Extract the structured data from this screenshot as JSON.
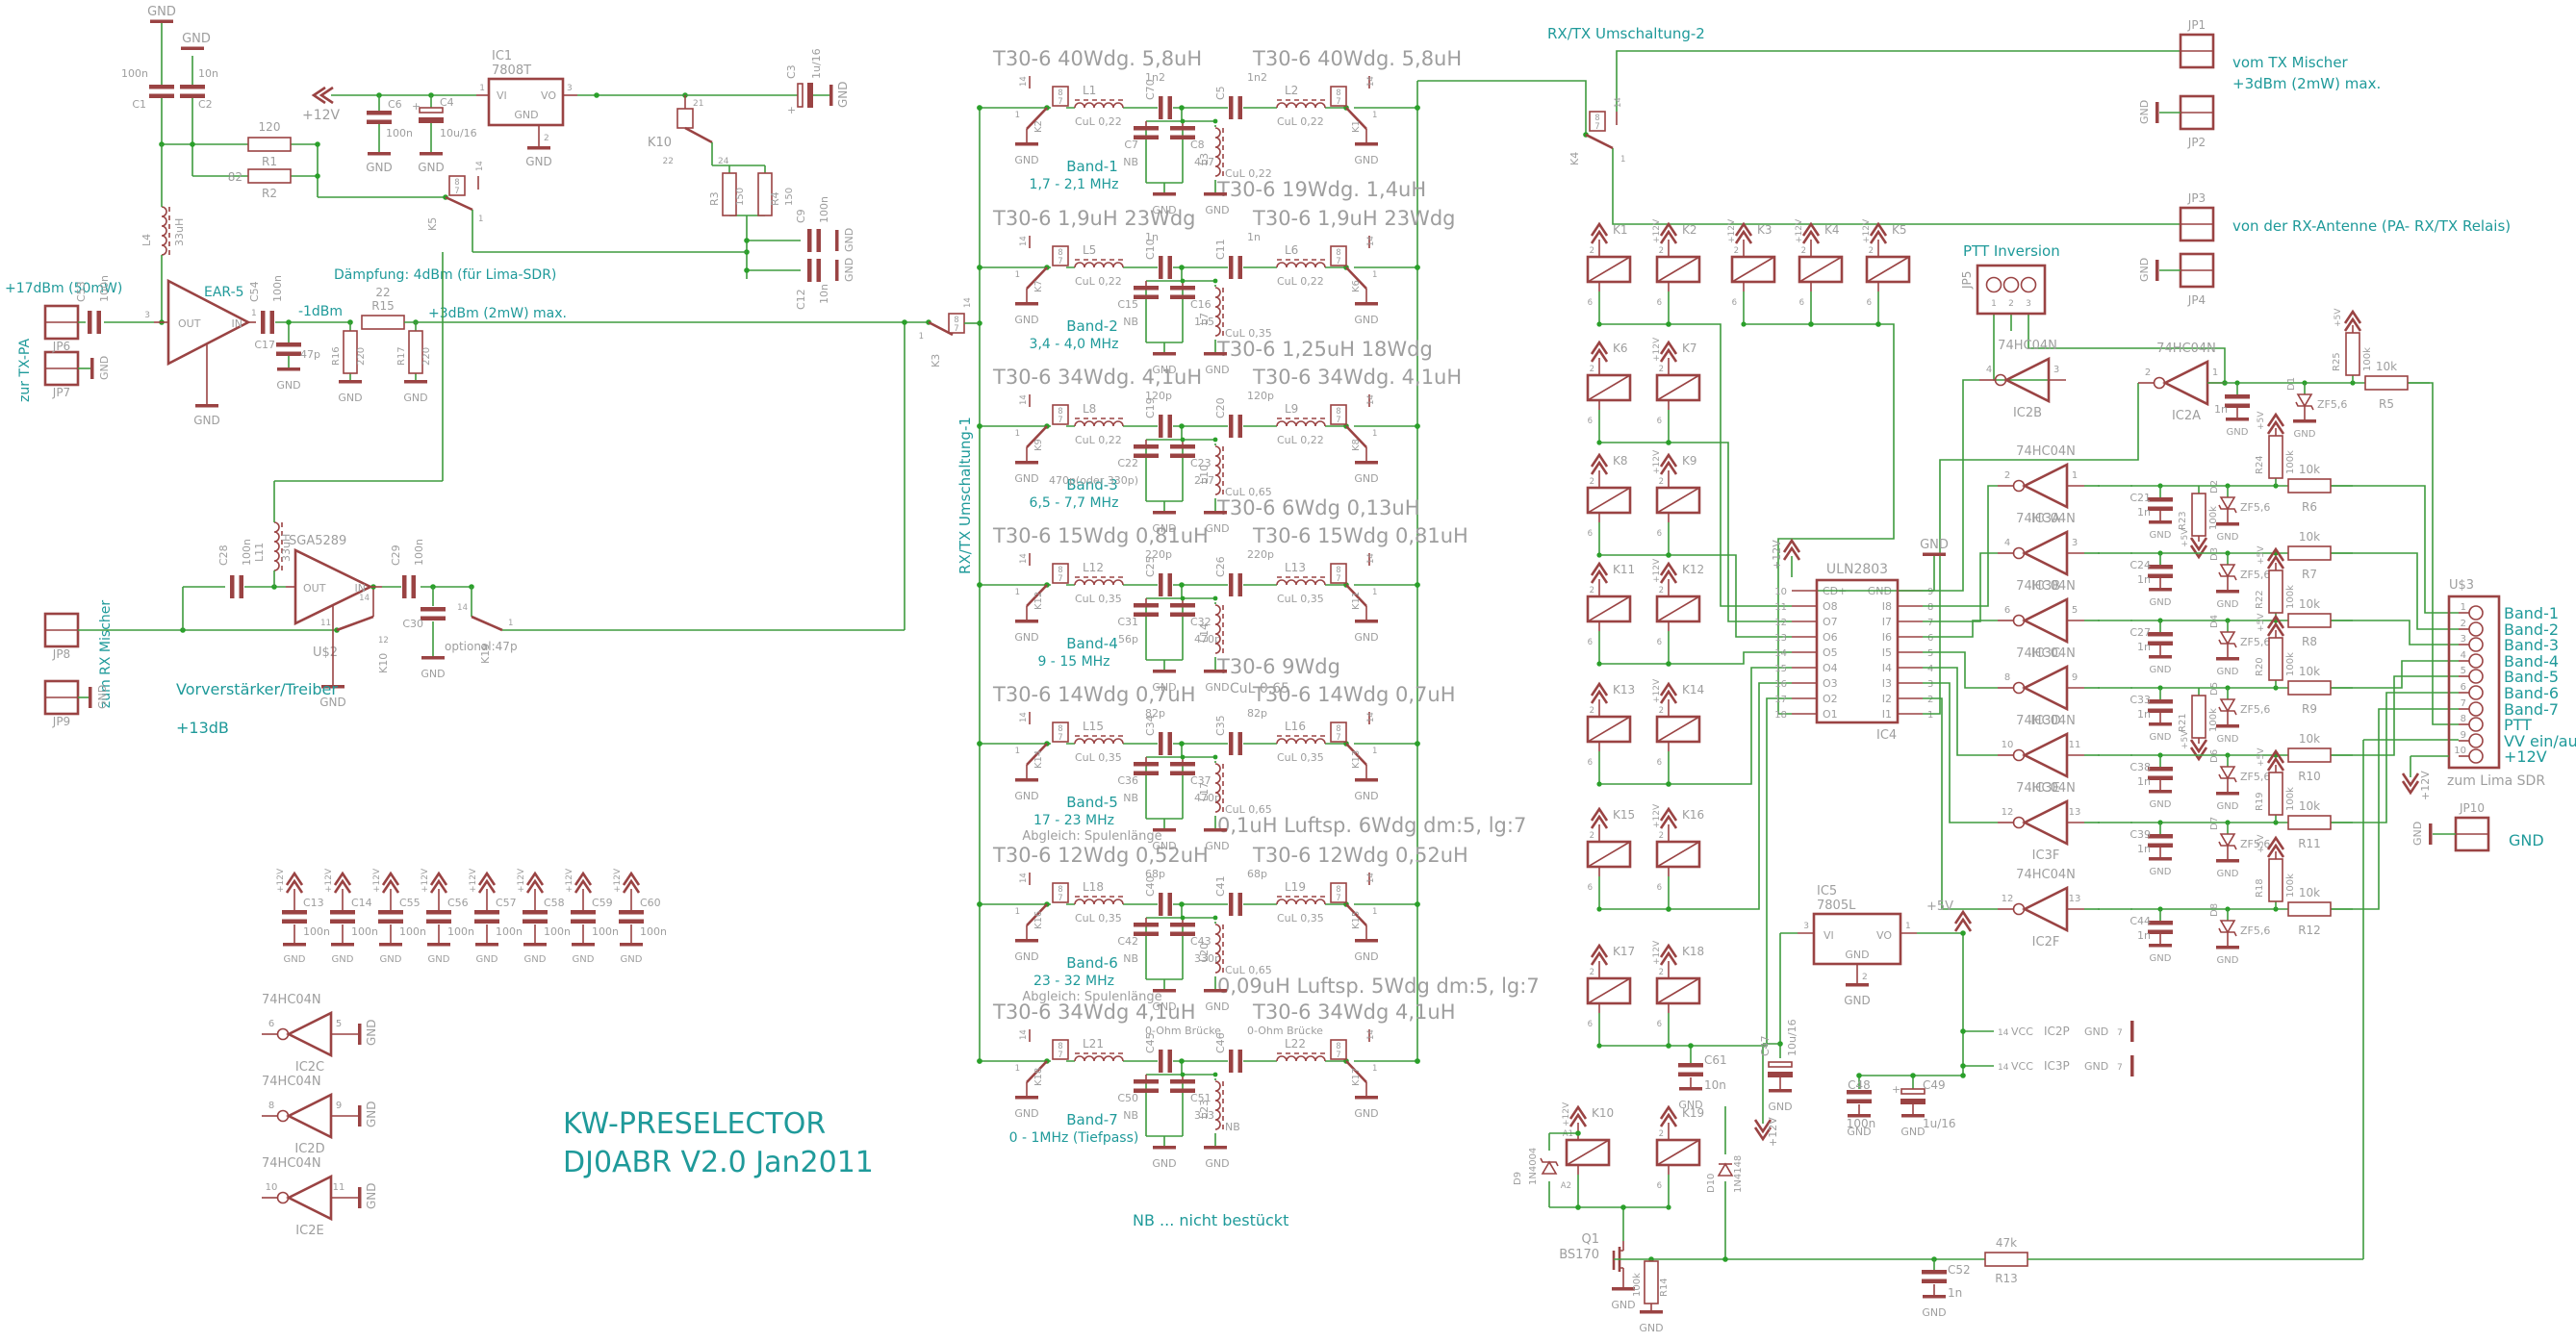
{
  "title": {
    "l1": "KW-PRESELECTOR",
    "l2": "DJ0ABR V2.0 Jan2011"
  },
  "shared": {
    "gnd": "GND",
    "p12": "+12V",
    "p5": "+5V",
    "vcc": "VCC",
    "hc": "74HC04N",
    "zf": "ZF5,6",
    "r10k": "10k",
    "v100n": "100n",
    "p1": "1",
    "p2": "2",
    "p3": "3",
    "p7": "7",
    "p8": "8",
    "p14": "14"
  },
  "notes": {
    "rxtx1": "RX/TX Umschaltung-1",
    "rxtx2": "RX/TX Umschaltung-2",
    "ptt": "PTT Inversion",
    "nb": "NB ... nicht bestückt",
    "vom_tx": "vom TX Mischer",
    "vom_tx_lvl": "+3dBm (2mW) max.",
    "von_rx": "von der RX-Antenne (PA- RX/TX Relais)",
    "zur_txpa": "zur TX-PA",
    "txpa_lvl": "+17dBm (50mW)",
    "zum_rx": "zum RX Mischer",
    "daempf": "Dämpfung: 4dBm (für Lima-SDR)",
    "m1dbm": "-1dBm",
    "p3dbm": "+3dBm (2mW) max.",
    "vorv": "Vorverstärker/Treiber",
    "p13": "+13dB",
    "zum_lima": "zum Lima SDR"
  },
  "psu": {
    "ic": "IC1",
    "part": "7808T",
    "vi": "VI",
    "vo": "VO",
    "gnd": "GND",
    "c1n": "C1",
    "c1v": "100n",
    "c2n": "C2",
    "c2v": "10n",
    "c6n": "C6",
    "c6v": "100n",
    "c4n": "C4",
    "c4v": "10u/16",
    "c3n": "C3",
    "c3v": "1u/16",
    "r1n": "R1",
    "r1v": "120",
    "r2n": "R2",
    "r2v": "82",
    "l4n": "L4",
    "l4v": "33uH",
    "k10": "K10",
    "k10a": "21",
    "k10b": "22",
    "k10c": "24",
    "k5": "K5",
    "r3n": "R3",
    "r3v": "150",
    "r4n": "R4",
    "r4v": "150",
    "c9n": "C9",
    "c9v": "100n",
    "c12n": "C12",
    "c12v": "10n"
  },
  "ear": {
    "name": "EAR-5",
    "out": "OUT",
    "in": "IN",
    "jp6": "JP6",
    "jp7": "JP7",
    "c53n": "C53",
    "c53v": "100n",
    "c54n": "C54",
    "c54v": "100n",
    "c17n": "C17",
    "c17v": "47p",
    "r15n": "R15",
    "r15v": "22",
    "r16n": "R16",
    "r16v": "220",
    "r17n": "R17",
    "r17v": "220"
  },
  "sga": {
    "name": "SGA5289",
    "ref": "U$2",
    "out": "OUT",
    "in": "IN",
    "jp8": "JP8",
    "jp9": "JP9",
    "c28n": "C28",
    "c28v": "100n",
    "c29n": "C29",
    "c29v": "100n",
    "c30n": "C30",
    "c30v": "optional:47p",
    "l11n": "L11",
    "l11v": "33uH",
    "k10": "K10",
    "k10a": "11",
    "k10b": "12",
    "k10c": "14",
    "k19": "K19"
  },
  "k3": "K3",
  "k4": "K4",
  "filters": [
    {
      "tl": "T30-6 40Wdg. 5,8uH",
      "tr": "T30-6 40Wdg. 5,8uH",
      "mid": "T30-6 19Wdg. 1,4uH",
      "mid2": "",
      "band": "Band-1",
      "range": "1,7 - 2,1 MHz",
      "note": "",
      "kl": "K2",
      "kr": "K1",
      "ll_n": "L1",
      "ll_v": "CuL 0,22",
      "lr_n": "L2",
      "lr_v": "CuL 0,22",
      "lm_n": "L3",
      "lm_v": "CuL 0,22",
      "csl_n": "C70",
      "csl_v": "1n2",
      "csr_n": "C5",
      "csr_v": "1n2",
      "cpa_n": "C7",
      "cpa_v": "NB",
      "cpb_n": "C8",
      "cpb_v": "4n7"
    },
    {
      "tl": "T30-6 1,9uH 23Wdg",
      "tr": "T30-6 1,9uH 23Wdg",
      "mid": "T30-6 1,25uH 18Wdg",
      "mid2": "",
      "band": "Band-2",
      "range": "3,4 - 4,0 MHz",
      "note": "",
      "kl": "K7",
      "kr": "K6",
      "ll_n": "L5",
      "ll_v": "CuL 0,22",
      "lr_n": "L6",
      "lr_v": "CuL 0,22",
      "lm_n": "L7",
      "lm_v": "CuL 0,35",
      "csl_n": "C10",
      "csl_v": "1n",
      "csr_n": "C11",
      "csr_v": "1n",
      "cpa_n": "C15",
      "cpa_v": "NB",
      "cpb_n": "C16",
      "cpb_v": "1n5"
    },
    {
      "tl": "T30-6 34Wdg. 4,1uH",
      "tr": "T30-6 34Wdg. 4,1uH",
      "mid": "T30-6 6Wdg 0,13uH",
      "mid2": "",
      "band": "Band-3",
      "range": "6,5 - 7,7 MHz",
      "note": "",
      "kl": "K9",
      "kr": "K8",
      "ll_n": "L8",
      "ll_v": "CuL 0,22",
      "lr_n": "L9",
      "lr_v": "CuL 0,22",
      "lm_n": "L10",
      "lm_v": "CuL 0,65",
      "csl_n": "C19",
      "csl_v": "120p",
      "csr_n": "C20",
      "csr_v": "120p",
      "cpa_n": "C22",
      "cpa_v": "470p(oder 330p)",
      "cpb_n": "C23",
      "cpb_v": "2n7"
    },
    {
      "tl": "T30-6 15Wdg 0,81uH",
      "tr": "T30-6 15Wdg 0,81uH",
      "mid": "T30-6 9Wdg",
      "mid2": "CuL 0,65",
      "band": "Band-4",
      "range": "9 - 15 MHz",
      "note": "",
      "kl": "K12",
      "kr": "K11",
      "ll_n": "L12",
      "ll_v": "CuL 0,35",
      "lr_n": "L13",
      "lr_v": "CuL 0,35",
      "lm_n": "L14",
      "lm_v": "",
      "csl_n": "C25",
      "csl_v": "220p",
      "csr_n": "C26",
      "csr_v": "220p",
      "cpa_n": "C31",
      "cpa_v": "56p",
      "cpb_n": "C32",
      "cpb_v": "470p"
    },
    {
      "tl": "T30-6 14Wdg 0,7uH",
      "tr": "T30-6 14Wdg 0,7uH",
      "mid": "0,1uH Luftsp. 6Wdg dm:5, lg:7",
      "mid2": "",
      "band": "Band-5",
      "range": "17 - 23 MHz",
      "note": "Abgleich: Spulenlänge",
      "kl": "K14",
      "kr": "K13",
      "ll_n": "L15",
      "ll_v": "CuL 0,35",
      "lr_n": "L16",
      "lr_v": "CuL 0,35",
      "lm_n": "L17",
      "lm_v": "CuL 0,65",
      "csl_n": "C34",
      "csl_v": "82p",
      "csr_n": "C35",
      "csr_v": "82p",
      "cpa_n": "C36",
      "cpa_v": "NB",
      "cpb_n": "C37",
      "cpb_v": "470p"
    },
    {
      "tl": "T30-6 12Wdg 0,52uH",
      "tr": "T30-6 12Wdg 0,52uH",
      "mid": "0,09uH Luftsp. 5Wdg dm:5, lg:7",
      "mid2": "",
      "band": "Band-6",
      "range": "23 - 32 MHz",
      "note": "Abgleich: Spulenlänge",
      "kl": "K16",
      "kr": "K15",
      "ll_n": "L18",
      "ll_v": "CuL 0,35",
      "lr_n": "L19",
      "lr_v": "CuL 0,35",
      "lm_n": "L20",
      "lm_v": "CuL 0,65",
      "csl_n": "C40",
      "csl_v": "68p",
      "csr_n": "C41",
      "csr_v": "68p",
      "cpa_n": "C42",
      "cpa_v": "NB",
      "cpb_n": "C43",
      "cpb_v": "330p"
    },
    {
      "tl": "T30-6 34Wdg 4,1uH",
      "tr": "T30-6 34Wdg 4,1uH",
      "mid": "",
      "mid2": "",
      "band": "Band-7",
      "range": "0 - 1MHz (Tiefpass)",
      "note": "",
      "kl": "K18",
      "kr": "K17",
      "ll_n": "L21",
      "ll_v": "",
      "lr_n": "L22",
      "lr_v": "",
      "lm_n": "L23",
      "lm_v": "NB",
      "csl_n": "C45",
      "csl_v": "0-Ohm Brücke",
      "csr_n": "C46",
      "csr_v": "0-Ohm Brücke",
      "cpa_n": "C50",
      "cpa_v": "NB",
      "cpb_n": "C51",
      "cpb_v": "3n3"
    }
  ],
  "bank": {
    "coils": [
      {
        "n": "K1",
        "p1": "2",
        "p2": "6",
        "v12": ""
      },
      {
        "n": "K2",
        "p1": "2",
        "p2": "6",
        "v12": "+12V"
      },
      {
        "n": "K3",
        "p1": "2",
        "p2": "6",
        "v12": "+12V"
      },
      {
        "n": "K4",
        "p1": "2",
        "p2": "6",
        "v12": "+12V"
      },
      {
        "n": "K5",
        "p1": "2",
        "p2": "6",
        "v12": "+12V"
      },
      {
        "n": "K6",
        "p1": "2",
        "p2": "6",
        "v12": ""
      },
      {
        "n": "K7",
        "p1": "2",
        "p2": "6",
        "v12": "+12V"
      },
      {
        "n": "K8",
        "p1": "2",
        "p2": "6",
        "v12": ""
      },
      {
        "n": "K9",
        "p1": "2",
        "p2": "6",
        "v12": "+12V"
      },
      {
        "n": "K11",
        "p1": "2",
        "p2": "6",
        "v12": ""
      },
      {
        "n": "K12",
        "p1": "2",
        "p2": "6",
        "v12": "+12V"
      },
      {
        "n": "K13",
        "p1": "2",
        "p2": "6",
        "v12": ""
      },
      {
        "n": "K14",
        "p1": "2",
        "p2": "6",
        "v12": "+12V"
      },
      {
        "n": "K15",
        "p1": "2",
        "p2": "6",
        "v12": ""
      },
      {
        "n": "K16",
        "p1": "2",
        "p2": "6",
        "v12": "+12V"
      },
      {
        "n": "K17",
        "p1": "2",
        "p2": "6",
        "v12": ""
      },
      {
        "n": "K18",
        "p1": "2",
        "p2": "6",
        "v12": "+12V"
      },
      {
        "n": "K10",
        "p1": "A1",
        "p2": "A2",
        "v12": "+12V"
      },
      {
        "n": "K19",
        "p1": "2",
        "p2": "6",
        "v12": ""
      }
    ],
    "d9n": "D9",
    "d9v": "1N4004",
    "d10n": "D10",
    "d10v": "1N4148",
    "q1n": "Q1",
    "q1v": "BS170",
    "r14n": "R14",
    "r14v": "100k",
    "c61n": "C61",
    "c61v": "10n"
  },
  "uln": {
    "ref": "IC4",
    "part": "ULN2803",
    "left": [
      {
        "pin": "10",
        "name": "CD+"
      },
      {
        "pin": "11",
        "name": "O8"
      },
      {
        "pin": "12",
        "name": "O7"
      },
      {
        "pin": "13",
        "name": "O6"
      },
      {
        "pin": "14",
        "name": "O5"
      },
      {
        "pin": "15",
        "name": "O4"
      },
      {
        "pin": "16",
        "name": "O3"
      },
      {
        "pin": "17",
        "name": "O2"
      },
      {
        "pin": "18",
        "name": "O1"
      }
    ],
    "right": [
      {
        "pin": "9",
        "name": "GND"
      },
      {
        "pin": "8",
        "name": "I8"
      },
      {
        "pin": "7",
        "name": "I7"
      },
      {
        "pin": "6",
        "name": "I6"
      },
      {
        "pin": "5",
        "name": "I5"
      },
      {
        "pin": "4",
        "name": "I4"
      },
      {
        "pin": "3",
        "name": "I3"
      },
      {
        "pin": "2",
        "name": "I2"
      },
      {
        "pin": "1",
        "name": "I1"
      }
    ]
  },
  "ic5": {
    "ref": "IC5",
    "part": "7805L",
    "vi": "VI",
    "vo": "VO",
    "gnd": "GND",
    "c47n": "C47",
    "c47v": "10u/16",
    "c48n": "C48",
    "c48v": "100n",
    "c49n": "C49",
    "c49v": "1u/16",
    "pwr": [
      {
        "ref": "IC2P",
        "vcc_pin": "14",
        "gnd_pin": "7"
      },
      {
        "ref": "IC3P",
        "vcc_pin": "14",
        "gnd_pin": "7"
      }
    ]
  },
  "jp5": {
    "ref": "JP5",
    "p1": "1",
    "p2": "2",
    "p3": "3"
  },
  "inverters": [
    {
      "ref": "IC2B",
      "o": "4",
      "i": "3"
    },
    {
      "ref": "IC2A",
      "o": "2",
      "i": "1"
    },
    {
      "ref": "IC3A",
      "o": "2",
      "i": "1"
    },
    {
      "ref": "IC3B",
      "o": "4",
      "i": "3"
    },
    {
      "ref": "IC3C",
      "o": "6",
      "i": "5"
    },
    {
      "ref": "IC3D",
      "o": "8",
      "i": "9"
    },
    {
      "ref": "IC3E",
      "o": "10",
      "i": "11"
    },
    {
      "ref": "IC3F",
      "o": "12",
      "i": "13"
    },
    {
      "ref": "IC2F",
      "o": "12",
      "i": "13"
    }
  ],
  "spares": [
    {
      "ref": "IC2C",
      "o": "6",
      "i": "5"
    },
    {
      "ref": "IC2D",
      "o": "8",
      "i": "9"
    },
    {
      "ref": "IC2E",
      "o": "10",
      "i": "11"
    }
  ],
  "prot": {
    "rows": [
      {
        "cn": "",
        "cv": "1n",
        "d": "D1",
        "r": "R5",
        "rv": "10k",
        "pu": "R25",
        "puv": "100k",
        "pd": "",
        "pdv": ""
      },
      {
        "cn": "C21",
        "cv": "1n",
        "d": "D2",
        "r": "R6",
        "rv": "10k",
        "pu": "R24",
        "puv": "100k",
        "pd": "R23",
        "pdv": "100k"
      },
      {
        "cn": "C24",
        "cv": "1n",
        "d": "D3",
        "r": "R7",
        "rv": "10k",
        "pu": "",
        "puv": "",
        "pd": "",
        "pdv": ""
      },
      {
        "cn": "C27",
        "cv": "1n",
        "d": "D4",
        "r": "R8",
        "rv": "10k",
        "pu": "R22",
        "puv": "100k",
        "pd": "",
        "pdv": ""
      },
      {
        "cn": "C33",
        "cv": "1n",
        "d": "D5",
        "r": "R9",
        "rv": "10k",
        "pu": "R20",
        "puv": "100k",
        "pd": "R21",
        "pdv": "100k"
      },
      {
        "cn": "C38",
        "cv": "1n",
        "d": "D6",
        "r": "R10",
        "rv": "10k",
        "pu": "",
        "puv": "",
        "pd": "",
        "pdv": ""
      },
      {
        "cn": "C39",
        "cv": "1n",
        "d": "D7",
        "r": "R11",
        "rv": "10k",
        "pu": "R19",
        "puv": "100k",
        "pd": "",
        "pdv": ""
      },
      {
        "cn": "C44",
        "cv": "1n",
        "d": "D8",
        "r": "R12",
        "rv": "10k",
        "pu": "R18",
        "puv": "100k",
        "pd": "",
        "pdv": ""
      }
    ]
  },
  "out": {
    "ref": "U$3",
    "pins": [
      {
        "n": "1",
        "label": "Band-1"
      },
      {
        "n": "2",
        "label": "Band-2"
      },
      {
        "n": "3",
        "label": "Band-3"
      },
      {
        "n": "4",
        "label": "Band-4"
      },
      {
        "n": "5",
        "label": "Band-5"
      },
      {
        "n": "6",
        "label": "Band-6"
      },
      {
        "n": "7",
        "label": "Band-7"
      },
      {
        "n": "8",
        "label": "PTT"
      },
      {
        "n": "9",
        "label": "VV ein/aus"
      },
      {
        "n": "10",
        "label": "+12V"
      }
    ]
  },
  "jps": {
    "jp1": "JP1",
    "jp2": "JP2",
    "jp3": "JP3",
    "jp4": "JP4",
    "jp10": "JP10",
    "jp10_lbl": "GND"
  },
  "misc": {
    "r13n": "R13",
    "r13v": "47k",
    "c52n": "C52",
    "c52v": "1n"
  },
  "capbank": [
    "C13",
    "C14",
    "C55",
    "C56",
    "C57",
    "C58",
    "C59",
    "C60"
  ]
}
